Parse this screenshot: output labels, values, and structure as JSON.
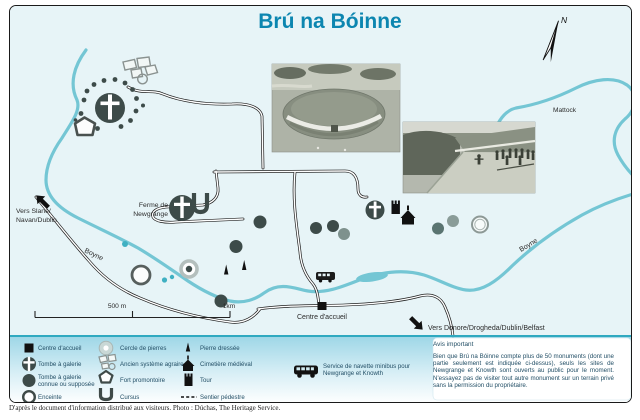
{
  "title": "Brú na Bóinne",
  "map": {
    "labels": {
      "vers_slane_1": "Vers Slane/",
      "vers_slane_2": "Navan/Dublin",
      "boyne_west": "Boyne",
      "boyne_east": "Boyne",
      "mattock": "Mattock",
      "ferme_1": "Ferme de",
      "ferme_2": "Newgrange",
      "centre_accueil": "Centre d'accueil",
      "vers_donore": "Vers Donore/Drogheda/Dublin/Belfast",
      "north": "N",
      "scale_500m": "500 m",
      "scale_1km": "1km"
    }
  },
  "legend": {
    "col1": [
      {
        "label": "Centre d'accueil",
        "icon": "visitor-centre-square"
      },
      {
        "label": "Tombe à galerie",
        "icon": "passage-tomb-cross-circle"
      },
      {
        "label": "Tombe à galerie connue ou supposée",
        "icon": "filled-circle"
      },
      {
        "label": "Enceinte",
        "icon": "open-circle"
      }
    ],
    "col2": [
      {
        "label": "Cercle de pierres",
        "icon": "stone-circle"
      },
      {
        "label": "Ancien système agraire",
        "icon": "field-system"
      },
      {
        "label": "Fort promontoire",
        "icon": "promontory-fort"
      },
      {
        "label": "Cursus",
        "icon": "cursus-u"
      }
    ],
    "col3": [
      {
        "label": "Pierre dressée",
        "icon": "standing-stone"
      },
      {
        "label": "Cimetière médiéval",
        "icon": "medieval-church"
      },
      {
        "label": "Tour",
        "icon": "tower"
      },
      {
        "label": "Sentier pédestre",
        "icon": "footpath-dashed-line"
      }
    ],
    "shuttle": "Service de navette minibus pour Newgrange et Knowth"
  },
  "notice": {
    "title": "Avis important",
    "body": "Bien que Brú na Bóinne compte plus de 50 monuments (dont une partie seulement est indiquée ci-dessus), seuls les sites de Newgrange et Knowth sont ouverts au public pour le moment. N'essayez pas de visiter tout autre monument sur un terrain privé sans la permission du propriétaire."
  },
  "footer": "D'après le document d'information distribué aux visiteurs. Photo : Dúchas, The Heritage Service.",
  "colors": {
    "title": "#0c86b0",
    "water": "#74c6d4",
    "monument_dark": "#3d4b49",
    "legend_text": "#234f66",
    "legend_band_top": "#9fd7e7"
  }
}
